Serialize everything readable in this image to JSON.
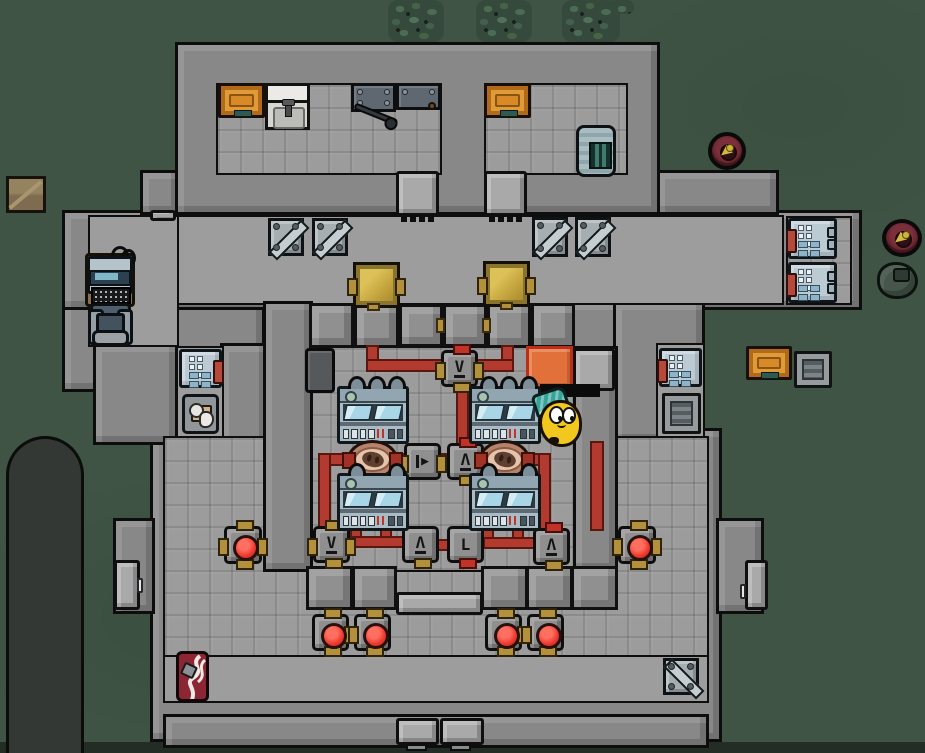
{
  "scene": {
    "view": "top-down colony base",
    "terrain": "grass field with berry bushes and a rock shadow column",
    "visible_text": "none"
  },
  "symbols": {
    "valve_down": "V",
    "valve_up": "Λ",
    "elbow": "L",
    "pump": "▶"
  },
  "palette": {
    "grass": "#3f5445",
    "bush": "#35493c",
    "wall": "#888888",
    "wall_outline": "#0d0d0d",
    "floor": "#9d9d9d",
    "pipe_red": "#b23a2e",
    "brass": "#b3903c",
    "battery_gold": "#c2a23c",
    "button_red": "#ef3b31",
    "door_orange": "#e2703a",
    "table_orange": "#d88a28",
    "machine_steel": "#a9bcc6",
    "pump_pink": "#e6c3ab",
    "mine_maroon": "#5e2029",
    "banner_red": "#8c2534",
    "pawn_yellow": "#f2c71e",
    "hat_teal": "#37a49c"
  },
  "entities": {
    "generators": 4,
    "fuel_pumps": 2,
    "valve_junction_boxes": 7,
    "red_button_valves": 6,
    "gold_batteries": 2,
    "fridge_units": 4,
    "vents": 3,
    "orange_tables": 3,
    "supply_crates": 5,
    "proximity_mines": 2,
    "doors": 9,
    "pawn": {
      "description": "yellow round colonist wearing teal headwrap",
      "count": 1
    }
  }
}
